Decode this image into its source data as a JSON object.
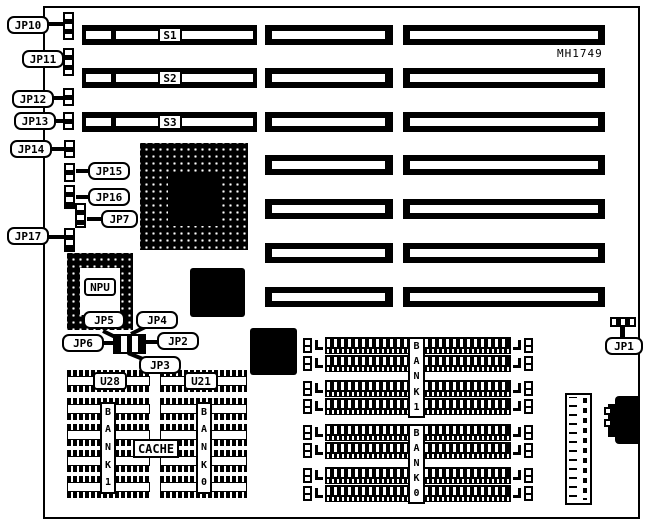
{
  "board": {
    "part_number": "MH1749"
  },
  "slots": {
    "s1": "S1",
    "s2": "S2",
    "s3": "S3"
  },
  "callouts": {
    "jp1": "JP1",
    "jp2": "JP2",
    "jp3": "JP3",
    "jp4": "JP4",
    "jp5": "JP5",
    "jp6": "JP6",
    "jp7": "JP7",
    "jp10": "JP10",
    "jp11": "JP11",
    "jp12": "JP12",
    "jp13": "JP13",
    "jp14": "JP14",
    "jp15": "JP15",
    "jp16": "JP16",
    "jp17": "JP17"
  },
  "chips": {
    "npu": "NPU",
    "u28": "U28",
    "u21": "U21"
  },
  "memory": {
    "cache": "CACHE",
    "cache_bank1": "BANK1",
    "cache_bank0": "BANK0",
    "simm_bank1": "BANK1",
    "simm_bank0": "BANK0"
  }
}
